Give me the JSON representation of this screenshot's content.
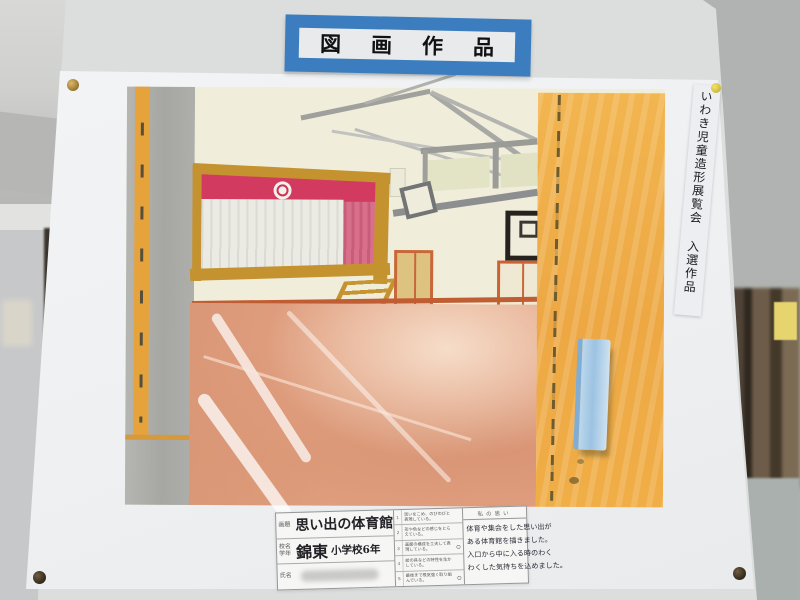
{
  "banner": {
    "text": "図画作品",
    "bg_color": "#3b7dbf"
  },
  "award_strip": {
    "text": "いわき児童造形展覧会 入選作品"
  },
  "painting": {
    "colors": {
      "wall_cream": "#f0eddb",
      "stage_crimson": "#d23a5f",
      "curtain_pink": "#d9708b",
      "frame_gold": "#c4922f",
      "floor_salmon": "#e2a283",
      "entrance_orange": "#eda844",
      "door_plate_blue": "#9cc3e2"
    }
  },
  "label_card": {
    "title_row": {
      "label": "画題",
      "value": "思い出の体育館"
    },
    "school_row": {
      "label": "校名 学年",
      "school": "錦東",
      "grade": "小学校6年"
    },
    "name_row": {
      "label": "氏名"
    },
    "checklist": {
      "items": [
        {
          "no": "1",
          "text": "思いをこめ、のびのびと表現している。",
          "mark": ""
        },
        {
          "no": "2",
          "text": "形や色などの感じをとらえている。",
          "mark": ""
        },
        {
          "no": "3",
          "text": "画面の構成を工夫して表現している。",
          "mark": "○"
        },
        {
          "no": "4",
          "text": "絵の具などの特性を生かしている。",
          "mark": ""
        },
        {
          "no": "5",
          "text": "最後まで根気強く取り組んでいる。",
          "mark": "○"
        }
      ]
    },
    "comment": {
      "header": "私の思い",
      "lines": [
        "体育や集会をした思い出が",
        "ある体育館を描きました。",
        "入口から中に入る時のわく",
        "わくした気持ちを込めました。"
      ]
    }
  }
}
